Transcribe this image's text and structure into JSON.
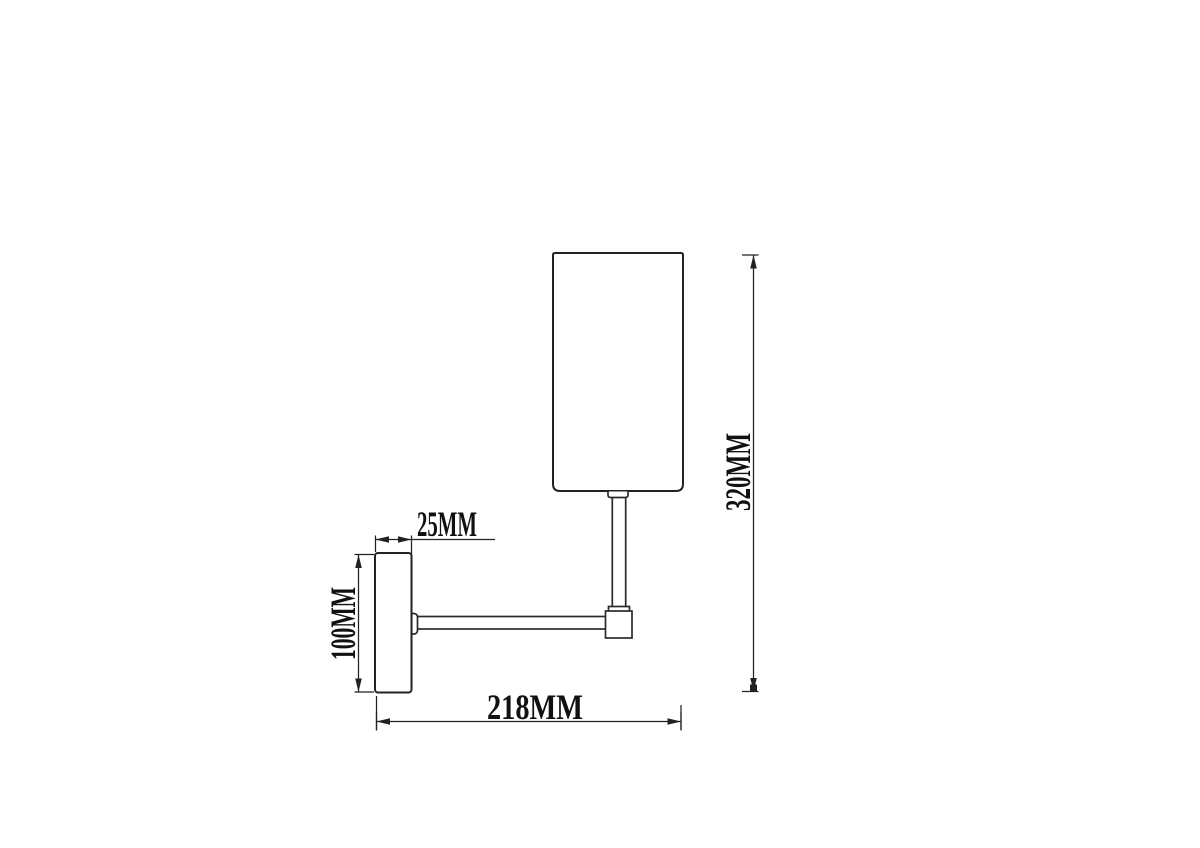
{
  "diagram": {
    "title": "wall-lamp-dimension-drawing",
    "units": "MM",
    "colors": {
      "line": "#222222",
      "text": "#111111",
      "background": "#ffffff"
    },
    "dimensions": {
      "plate_depth": {
        "label": "25MM",
        "value": 25,
        "orientation": "horizontal"
      },
      "plate_height": {
        "label": "100MM",
        "value": 100,
        "orientation": "vertical"
      },
      "overall_width": {
        "label": "218MM",
        "value": 218,
        "orientation": "horizontal"
      },
      "overall_height": {
        "label": "320MM",
        "value": 320,
        "orientation": "vertical"
      }
    },
    "parts": [
      "lamp-shade",
      "shade-neck",
      "stem",
      "stem-collar",
      "elbow-joint",
      "arm",
      "arm-flange",
      "wall-plate"
    ]
  }
}
